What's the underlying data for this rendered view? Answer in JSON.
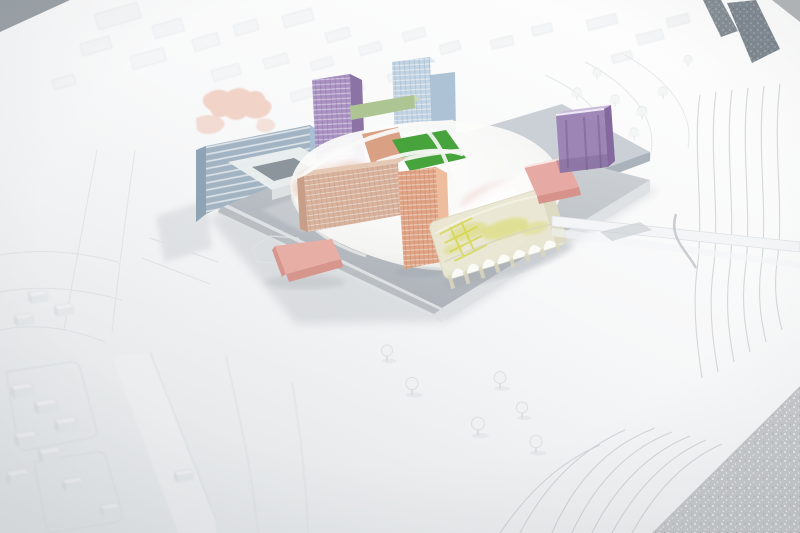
{
  "scene": {
    "subject": "architectural-scale-model-photo",
    "elements": [
      "site-board",
      "floor-sparkle-corner",
      "dark-texture-strips",
      "context-blocks",
      "contour-lines",
      "model-trees",
      "central-platform",
      "plaza-slab",
      "courtyard-building-blue",
      "tower-purple",
      "tower-blue",
      "slab-green",
      "canopy-roof",
      "field-green",
      "slab-building-orange",
      "tower-orange",
      "vaulted-hall-yellow",
      "slab-pink",
      "box-purple",
      "box-pink",
      "pink-zone-patches",
      "access-road"
    ]
  },
  "colors": {
    "background": "#b2b6b9",
    "background_corner": "#9aa1a6",
    "floor_sparkle": "#c6c9cb",
    "board_top": "#fdfdfd",
    "board_mid": "#f5f6f7",
    "board_bottom": "#e9eced",
    "strip_dark": "#7f8890",
    "road_white": "#f3f5f6",
    "block_white": "#f4f5f6",
    "block_shadow": "#e2e6e8",
    "patch_pink": "#eec3b3",
    "plaza_gray": "#c6ccd3",
    "plaza_edge": "#aab2bb",
    "platform_light": "#d0d4d8",
    "platform_dark": "#a9afb6",
    "platform_face": "#dfe2e5",
    "platform_face_dark": "#8d949b",
    "bldg_blue": "#a2b4c3",
    "bldg_blue_side": "#8ea3b5",
    "bldg_blue_top": "#d2dbe2",
    "courtyard_frame": "#eaeef0",
    "courtyard_inner": "#8d959c",
    "tower_purple": "#a78fc0",
    "tower_purple_side": "#8b73a5",
    "tower_purple_top": "#c6b5d8",
    "tower_blue": "#c0d2e2",
    "tower_blue_side": "#a9bfd3",
    "tower_blue_top": "#dde7ef",
    "slab_green_top": "#ccd9b3",
    "slab_green_face": "#adc493",
    "canopy_core": "#fbfbf9",
    "canopy_edge": "#e8e8e4",
    "field_green": "#47a33c",
    "under_orange": "#d79b7c",
    "under_pink": "#e8b4ab",
    "rib_white": "#f8f8f6",
    "bldg_orange": "#d8b29c",
    "bldg_orange_top": "#e6c9b5",
    "bldg_orange_side": "#c89e88",
    "tower_orange": "#e0a485",
    "tower_orange_side": "#edbd9e",
    "tower_orange_top": "#eec6a9",
    "vault_cream": "#eae8d4",
    "vault_yellow": "#d4d441",
    "vault_side": "#dbd8bf",
    "slab_pink_top": "#e7a9a4",
    "slab_pink_face": "#d8928c",
    "box_pink_top": "#e9afa5",
    "box_pink_face": "#d9968c",
    "box_purple": "#9a81b4",
    "box_purple_side": "#84699e",
    "box_purple_top": "#cbbcdb",
    "tree_fill": "#f3f5f5",
    "tree_stroke": "#dde1e3",
    "shadow_soft": "#9fa6ac"
  }
}
